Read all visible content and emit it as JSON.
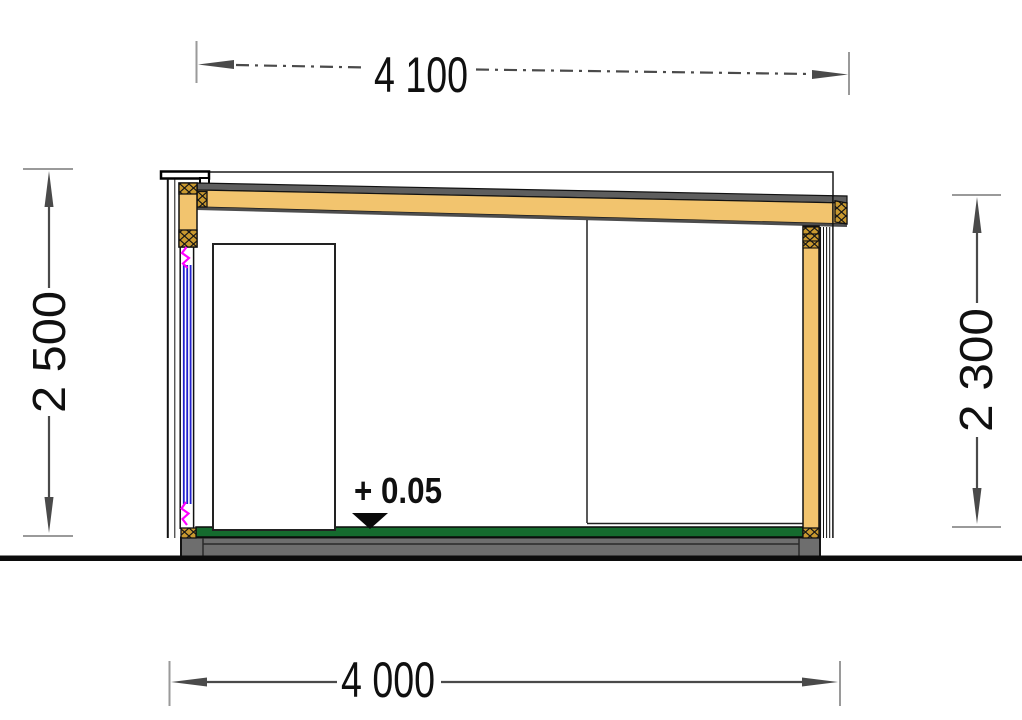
{
  "drawing": {
    "type": "section-elevation",
    "level_marker": {
      "label": "+ 0.05"
    },
    "dimensions": {
      "top": {
        "label": "4 100"
      },
      "bottom": {
        "label": "4 000"
      },
      "left": {
        "label": "2 500"
      },
      "right": {
        "label": "2 300"
      }
    }
  },
  "colors": {
    "wood": "#F2C46E",
    "wood_hatch": "#C9992F",
    "roof_gray": "#5E5E5E",
    "roof_shade": "#4D4D4D",
    "floor_green": "#156B2E",
    "foundation_gray": "#6E6E6E",
    "ground_black": "#0C0C0C",
    "glazing_blue": "#2121CC",
    "seal_magenta": "#FF00FF",
    "dim_gray": "#4A4A4A",
    "tick_gray": "#9A9A9A",
    "text_black": "#101010"
  }
}
